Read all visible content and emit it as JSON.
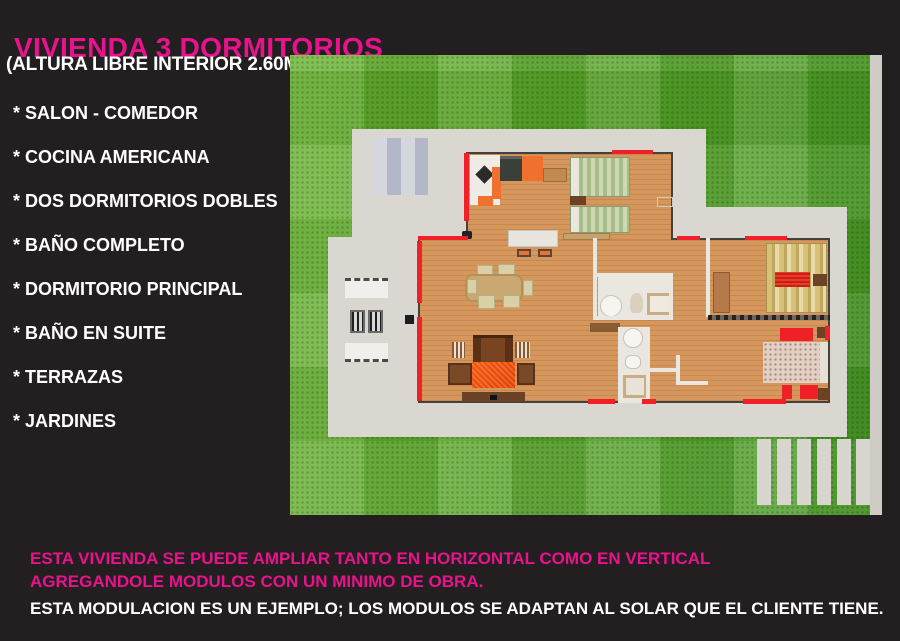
{
  "header": {
    "title": "VIVIENDA 3 DORMITORIOS",
    "subtitle": "(ALTURA LIBRE INTERIOR 2.60M.)"
  },
  "features": [
    "* SALON - COMEDOR",
    "* COCINA AMERICANA",
    "* DOS DORMITORIOS DOBLES",
    "* BAÑO COMPLETO",
    "* DORMITORIO PRINCIPAL",
    "* BAÑO EN SUITE",
    "* TERRAZAS",
    "* JARDINES"
  ],
  "footer": {
    "line1": "ESTA VIVIENDA SE PUEDE AMPLIAR TANTO EN HORIZONTAL COMO EN VERTICAL",
    "line2": "AGREGANDOLE MODULOS CON UN MINIMO DE OBRA.",
    "line3": "ESTA MODULACION ES UN EJEMPLO; LOS MODULOS SE ADAPTAN AL SOLAR QUE EL CLIENTE TIENE."
  },
  "colors": {
    "background": "#231f20",
    "accent_magenta": "#e8138c",
    "text_white": "#ffffff",
    "grass_green": "#58a82e",
    "terrace_gray": "#dad7d1",
    "floor_wood": "#d6975c",
    "door_red": "#f02028"
  }
}
